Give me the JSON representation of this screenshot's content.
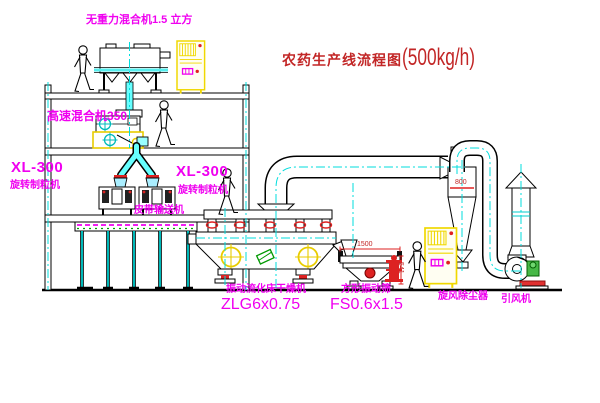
{
  "title": {
    "cn": "农药生产线流程图",
    "capacity": "(500kg/h)"
  },
  "labels": {
    "gravity_mixer": "无重力混合机1.5 立方",
    "high_speed_mixer": "高速混合机350",
    "granulator_model_left": "XL-300",
    "granulator_left": "旋转制粒机",
    "granulator_model_right": "XL-300",
    "granulator_right": "旋转制粒机",
    "belt_conveyor": "皮带输送机",
    "dryer_name": "振动流化床干燥机",
    "dryer_model": "ZLG6x0.75",
    "sieve_name": "方形振动筛",
    "sieve_model": "FS0.6x1.5",
    "cyclone": "旋风除尘器",
    "fan": "引风机"
  },
  "dimensions": {
    "sieve_length": "1500",
    "sieve_height": "541",
    "cyclone_width": "800"
  },
  "colors": {
    "label_magenta": "#f000f0",
    "title_red": "#c22626",
    "pipe_cyan": "#00dddd",
    "cabinet_yellow": "#f0d800",
    "line_black": "#000000"
  }
}
